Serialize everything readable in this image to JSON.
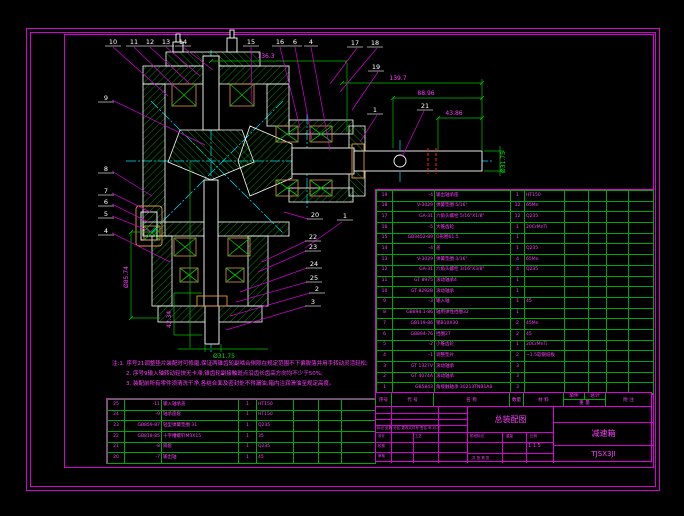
{
  "drawing": {
    "dims": {
      "top_width": "136.3",
      "shaft_len_total": "139.7",
      "shaft_len_mid": "88.96",
      "shaft_len_end": "43.86",
      "shaft_dia_right": "Ø31.75",
      "flange_dia_left": "Ø85.74",
      "boss_height": "42.34",
      "shaft_dia_bottom": "Ø31.75"
    },
    "callouts": {
      "top": [
        "10",
        "11",
        "12",
        "13",
        "14",
        "15",
        "16",
        "6",
        "4"
      ],
      "left": [
        "9",
        "8",
        "7",
        "6",
        "5",
        "4"
      ],
      "right": [
        "17",
        "18",
        "19",
        "1",
        "21"
      ],
      "bottom": [
        "20",
        "1",
        "22",
        "23",
        "24",
        "25",
        "2",
        "3"
      ]
    }
  },
  "notes": {
    "line1": "注:1. 序号21调整垫片装配时可修磨,保证两锥齿轮副啮合侧隙在规定范围不下偏脱落并用手转动灵活轻松;",
    "line2": "2. 序号9输入轴转动轻快无卡滞,锥齿轮副接触斑点沿齿长齿高方向均不少于50%;",
    "line3": "3. 装配前所有零件须清洗干净,各结合面及密封处不得漏油,箱内注润滑油至规定高度。"
  },
  "parts_right": {
    "rows": [
      {
        "no": "19",
        "code": "-4",
        "name": "输出轴承座",
        "qty": "1",
        "material": "HT150"
      },
      {
        "no": "18",
        "code": "V-3029",
        "name": "弹簧垫圈 5/16\"",
        "qty": "12",
        "material": "65Mn"
      },
      {
        "no": "17",
        "code": "GA-31",
        "name": "六角头螺栓 5/16\"X1/8\"",
        "qty": "12",
        "material": "Q235"
      },
      {
        "no": "16",
        "code": "-5",
        "name": "大锥齿轮",
        "qty": "1",
        "material": "20CrMnTi"
      },
      {
        "no": "15",
        "code": "GB3452-89",
        "name": "O形圈61.5",
        "qty": "1",
        "material": ""
      },
      {
        "no": "14",
        "code": "-4",
        "name": "盖",
        "qty": "1",
        "material": "Q235"
      },
      {
        "no": "13",
        "code": "V-3029",
        "name": "弹簧垫圈 3/16\"",
        "qty": "4",
        "material": "65Mn"
      },
      {
        "no": "12",
        "code": "GA-31",
        "name": "六角头螺栓 3/16\"X3/8\"",
        "qty": "4",
        "material": "Q235"
      },
      {
        "no": "11",
        "code": "GT 8975",
        "name": "滚动轴承4",
        "qty": "1",
        "material": ""
      },
      {
        "no": "10",
        "code": "GT 8292B",
        "name": "滚动轴承",
        "qty": "1",
        "material": ""
      },
      {
        "no": "9",
        "code": "-3",
        "name": "输入轴",
        "qty": "1",
        "material": "45"
      },
      {
        "no": "8",
        "code": "GB894.1-86",
        "name": "轴用弹性挡圈32",
        "qty": "1",
        "material": ""
      },
      {
        "no": "7",
        "code": "GB119-86",
        "name": "销B10X30",
        "qty": "2",
        "material": "45Mn"
      },
      {
        "no": "6",
        "code": "GB894-76",
        "name": "挡圈27",
        "qty": "2",
        "material": "45"
      },
      {
        "no": "5",
        "code": "-2",
        "name": "小锥齿轮",
        "qty": "1",
        "material": "20CrMnTi"
      },
      {
        "no": "4",
        "code": "-1",
        "name": "调整垫片",
        "qty": "2",
        "material": "~1.5软钢纸板"
      },
      {
        "no": "3",
        "code": "GT 1327V",
        "name": "滚动轴承",
        "qty": "3",
        "material": ""
      },
      {
        "no": "2",
        "code": "GT 4074A",
        "name": "滚动轴承",
        "qty": "3",
        "material": ""
      },
      {
        "no": "1",
        "code": "GB5843",
        "name": "角接触轴承 30213TNB1A8",
        "qty": "3",
        "material": ""
      }
    ]
  },
  "parts_left": {
    "rows": [
      {
        "no": "25",
        "code": "-11",
        "name": "输入轴承盖",
        "qty": "1",
        "material": "HT150"
      },
      {
        "no": "24",
        "code": "-9",
        "name": "轴承座套",
        "qty": "1",
        "material": "HT150"
      },
      {
        "no": "23",
        "code": "GB859-87",
        "name": "轻型弹簧垫圈 31",
        "qty": "1",
        "material": "Q235"
      },
      {
        "no": "22",
        "code": "GB818-85",
        "name": "十字槽螺钉M3X15",
        "qty": "1",
        "material": "35"
      },
      {
        "no": "21",
        "code": "-8",
        "name": "隔套",
        "qty": "1",
        "material": "Q235"
      },
      {
        "no": "20",
        "code": "-7",
        "name": "输出轴",
        "qty": "1",
        "material": "45"
      }
    ]
  },
  "table_header": {
    "no": "序号",
    "code": "代 号",
    "name": "名   称",
    "qty": "数量",
    "material": "材   料",
    "unit": "单件",
    "total": "总计",
    "weight": "重 量",
    "note": "附 注"
  },
  "title_block": {
    "title": "总装配图",
    "product": "减速箱",
    "drawing_no": "TJSX3JI",
    "rev_row": "标记 处数 分区  更改文件号  签名  年.月.日",
    "sign1": "设计",
    "sign2": "校核",
    "sign3": "审核",
    "sign4": "工艺",
    "stage_label": "阶段标记",
    "weight_label": "重量",
    "scale_label": "比例",
    "scale": "1:1.5",
    "sheet": "共 张  第 张"
  }
}
